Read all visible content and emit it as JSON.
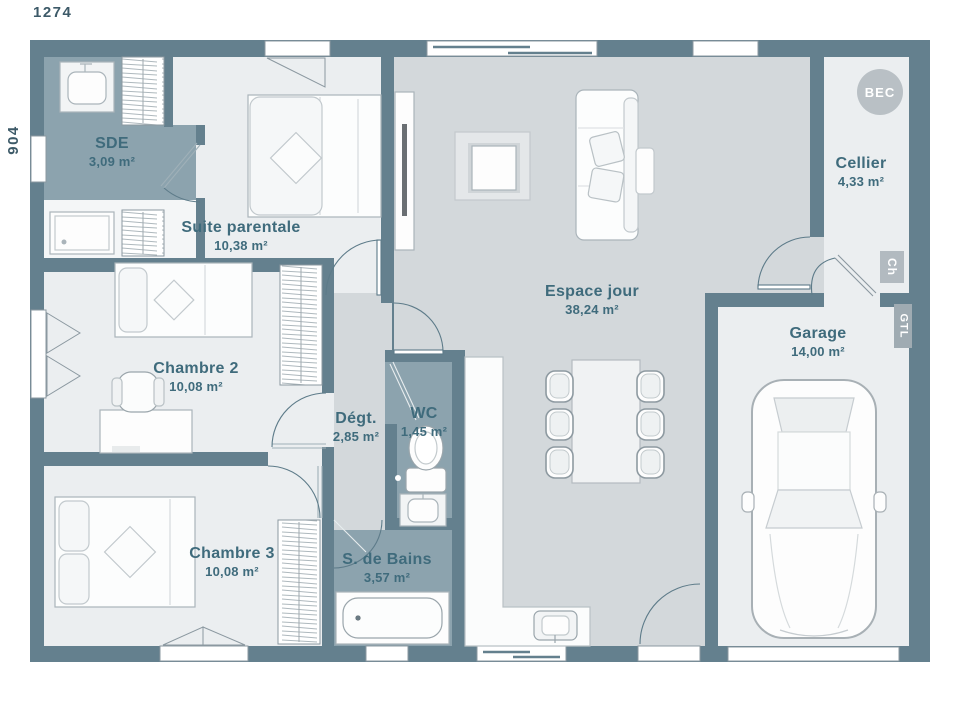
{
  "dimensions": {
    "width": "1274",
    "height": "904"
  },
  "rooms": [
    {
      "id": "sde",
      "name": "SDE",
      "area": "3,09 m²"
    },
    {
      "id": "suite-parentale",
      "name": "Suite parentale",
      "area": "10,38 m²"
    },
    {
      "id": "chambre-2",
      "name": "Chambre 2",
      "area": "10,08 m²"
    },
    {
      "id": "chambre-3",
      "name": "Chambre 3",
      "area": "10,08 m²"
    },
    {
      "id": "degagement",
      "name": "Dégt.",
      "area": "2,85 m²"
    },
    {
      "id": "wc",
      "name": "WC",
      "area": "1,45 m²"
    },
    {
      "id": "salle-de-bains",
      "name": "S. de Bains",
      "area": "3,57 m²"
    },
    {
      "id": "espace-jour",
      "name": "Espace jour",
      "area": "38,24 m²"
    },
    {
      "id": "cellier",
      "name": "Cellier",
      "area": "4,33 m²"
    },
    {
      "id": "garage",
      "name": "Garage",
      "area": "14,00 m²"
    }
  ],
  "annotations": {
    "bec": "BEC",
    "ch": "Ch",
    "gtl": "GTL"
  },
  "colors": {
    "wall": "#64808e",
    "floor_light": "#ebeef0",
    "floor_main": "#d3d8db",
    "floor_wet": "#8ca3ae",
    "label_text": "#3f6b7c",
    "dimension_text": "#3d5a68",
    "badge_gray": "#b9c0c5"
  }
}
